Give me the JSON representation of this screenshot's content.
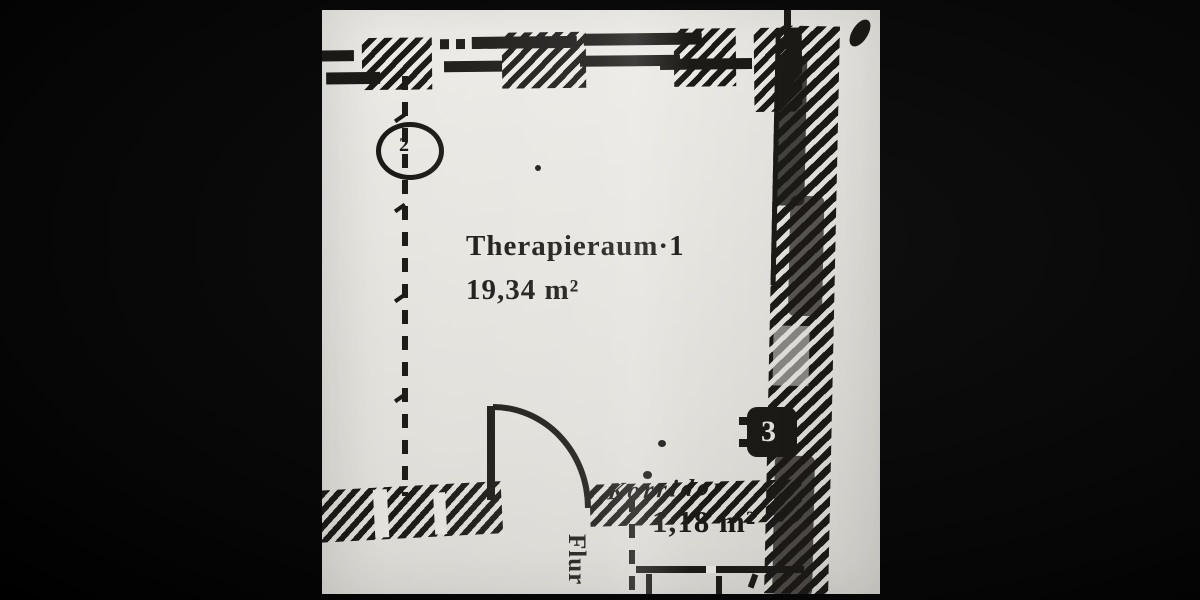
{
  "colors": {
    "photo_background": "#070707",
    "paper": "#e4e2dd",
    "ink": "#1c1a17"
  },
  "plan": {
    "rooms": [
      {
        "id": "therapieraum",
        "label": "Therapieraum·1",
        "area": "19,34 m²"
      },
      {
        "id": "korridor",
        "label": "Korridor",
        "area": "1,18 m²"
      },
      {
        "id": "flur",
        "label": "Flur"
      }
    ],
    "symbols": [
      {
        "id": "oval-marker",
        "glyph": "2"
      },
      {
        "id": "junction-box",
        "glyph": "3"
      }
    ]
  }
}
